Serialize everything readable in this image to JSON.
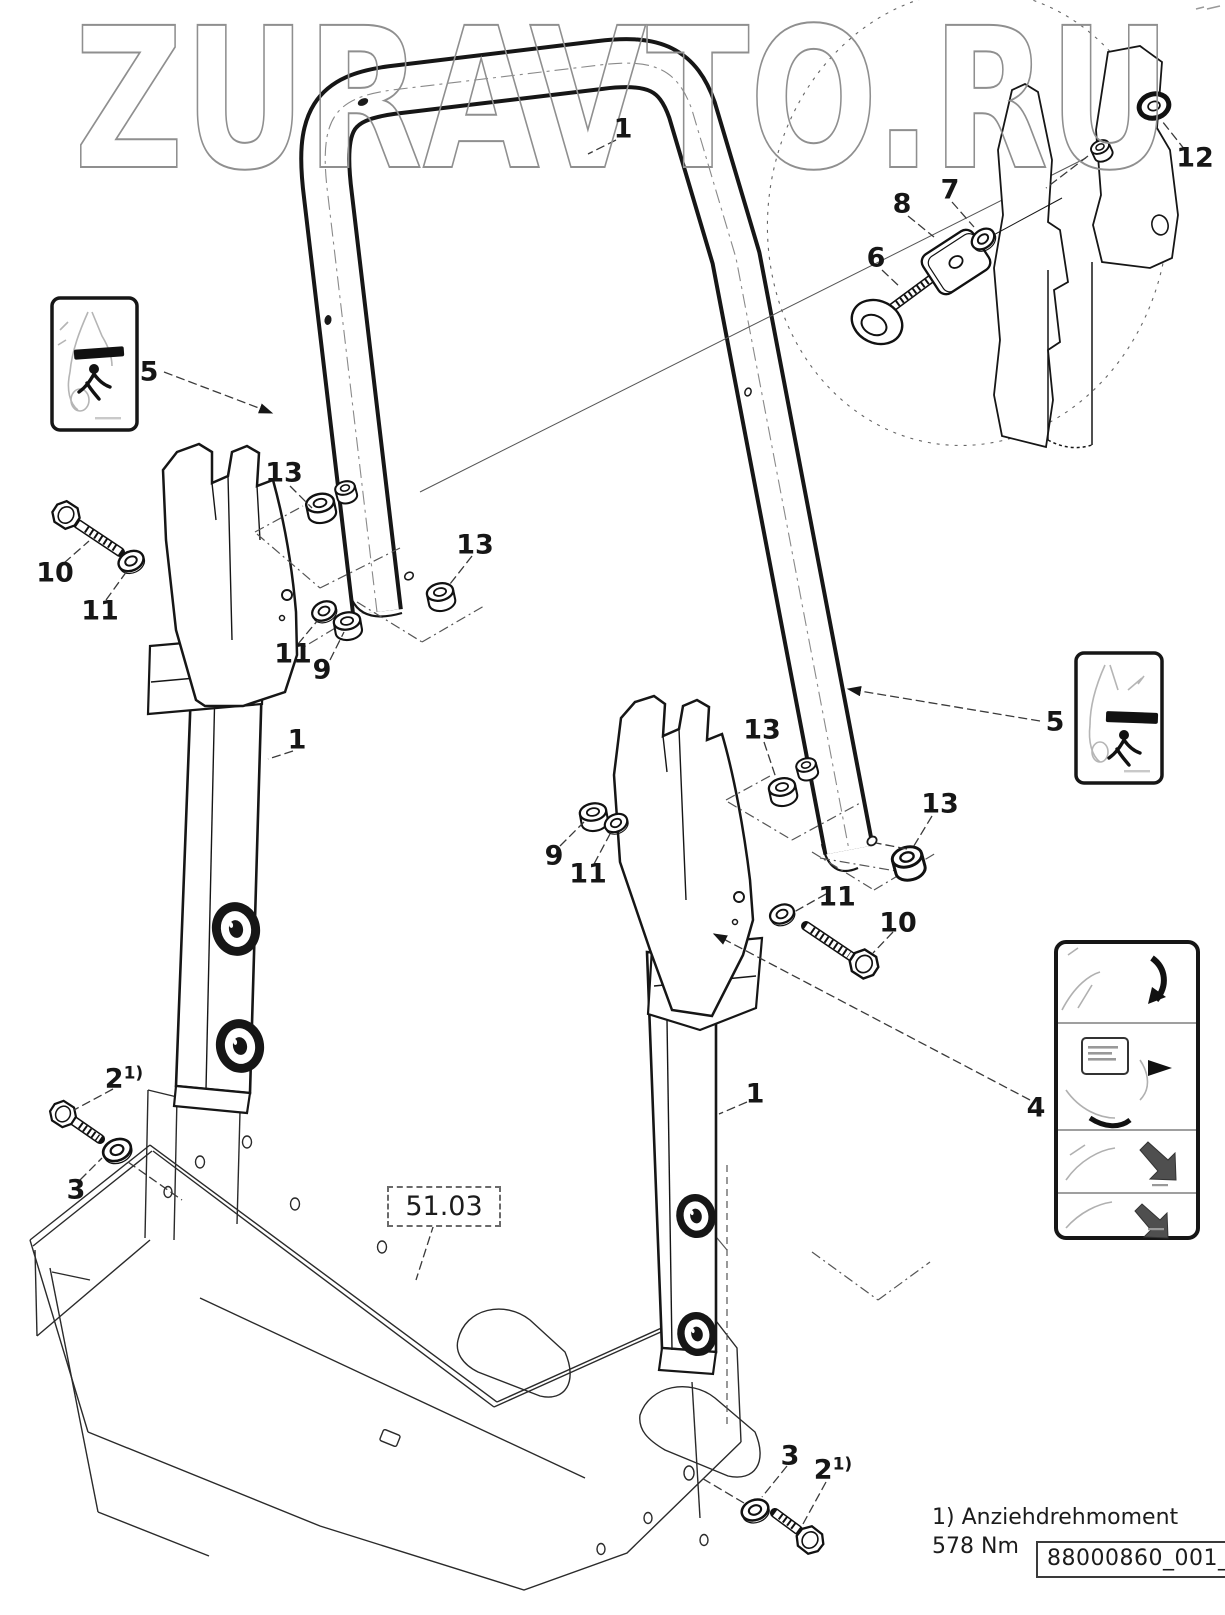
{
  "watermark": "ZURAVTO.RU",
  "callouts": [
    {
      "part": "roll-bar-hoop",
      "label": "1"
    },
    {
      "part": "grommet",
      "label": "12"
    },
    {
      "part": "washer",
      "label": "7"
    },
    {
      "part": "clamp-pad",
      "label": "8"
    },
    {
      "part": "eye-bolt",
      "label": "6"
    },
    {
      "part": "crush-hazard-decal-left",
      "label": "5"
    },
    {
      "part": "crush-hazard-decal-right",
      "label": "5"
    },
    {
      "part": "flange-nut",
      "label": "13"
    },
    {
      "part": "flange-bushing",
      "label": "13"
    },
    {
      "part": "hex-bolt-left",
      "label": "10"
    },
    {
      "part": "washer-left",
      "label": "11"
    },
    {
      "part": "washer-mid",
      "label": "11"
    },
    {
      "part": "flange-nut-left",
      "label": "9"
    },
    {
      "part": "support-post-left",
      "label": "1"
    },
    {
      "part": "flange-nut-upper-right",
      "label": "13"
    },
    {
      "part": "flange-bushing-right",
      "label": "13"
    },
    {
      "part": "flange-nut-right",
      "label": "9"
    },
    {
      "part": "washer-right-a",
      "label": "11"
    },
    {
      "part": "washer-right-b",
      "label": "11"
    },
    {
      "part": "hex-bolt-right",
      "label": "10"
    },
    {
      "part": "support-post-right",
      "label": "1"
    },
    {
      "part": "instruction-decal",
      "label": "4"
    },
    {
      "part": "hex-flange-bolt-bottom-left",
      "label": "2",
      "sup": "1)"
    },
    {
      "part": "washer-bottom-left",
      "label": "3"
    },
    {
      "part": "washer-bottom-right",
      "label": "3"
    },
    {
      "part": "hex-flange-bolt-bottom-right",
      "label": "2",
      "sup": "1)"
    }
  ],
  "reference_box": {
    "label": "51.03"
  },
  "footnote": {
    "text": "1) Anziehdrehmoment 578 Nm"
  },
  "document_number": {
    "text": "88000860_001_00"
  },
  "decals": {
    "left_warning": "crush-hazard-pictogram",
    "right_warning": "crush-hazard-pictogram",
    "instructions": "rops-folding-instruction-pictograms"
  },
  "colors": {
    "line": "#1a1a1a",
    "leader": "#3a3a3a",
    "phantom": "#555555",
    "watermark_outline": "#8f8f8f",
    "decal_sketch": "#b5b5b5",
    "decal_arrow": "#4f4f4f"
  }
}
